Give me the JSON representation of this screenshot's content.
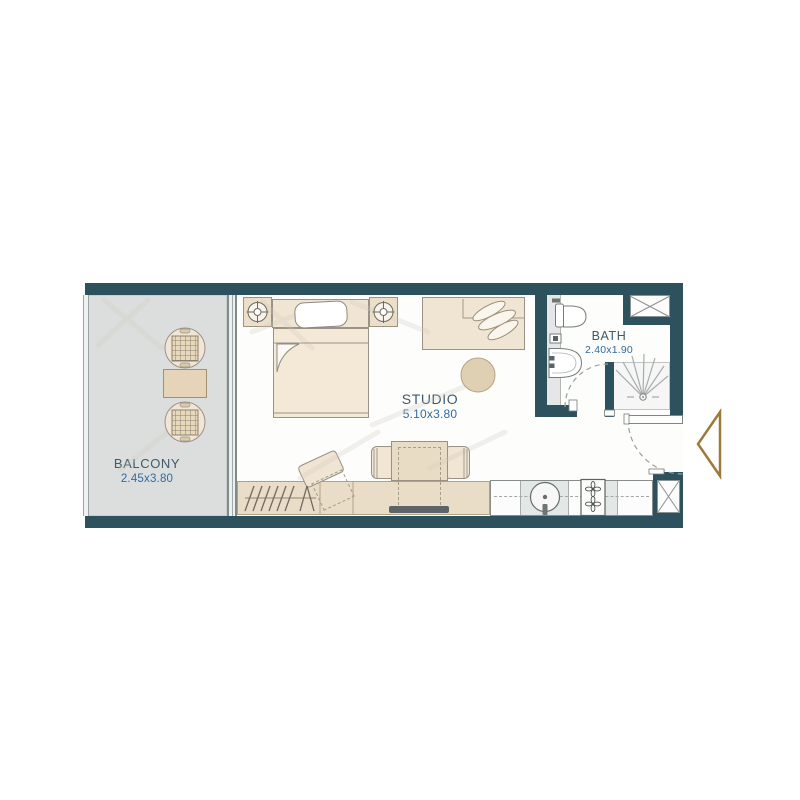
{
  "title": "Studio apartment floor plan",
  "plan": {
    "rooms": [
      {
        "name": "BALCONY",
        "dimensions": "2.45x3.80"
      },
      {
        "name": "STUDIO",
        "dimensions": "5.10x3.80"
      },
      {
        "name": "BATH",
        "dimensions": "2.40x1.90"
      }
    ],
    "colors": {
      "wall": "#2e515e",
      "balcony_floor": "#dbdedd",
      "studio_floor": "#fdfdfc",
      "furniture_fill": "#f0e4d2",
      "furniture_band": "#e9ddc7",
      "kitchen_gray": "#e3e7e6",
      "room_label_text": "#3f5a68",
      "dimension_text": "#2f6ba4",
      "entry_marker": "#9c7b3a",
      "fixture_outline": "#757c7a"
    },
    "icons": {
      "entry_marker": "left-pointing-triangle-outline",
      "nightstand_lamp": "circle-with-crosshair",
      "service_shaft": "box-with-x",
      "shower": "radiating-spray-lines-with-drain",
      "stove": "two-four-petal-burners",
      "wardrobe": "slanted-hanger-lines",
      "plant": "leaf-cluster"
    }
  }
}
